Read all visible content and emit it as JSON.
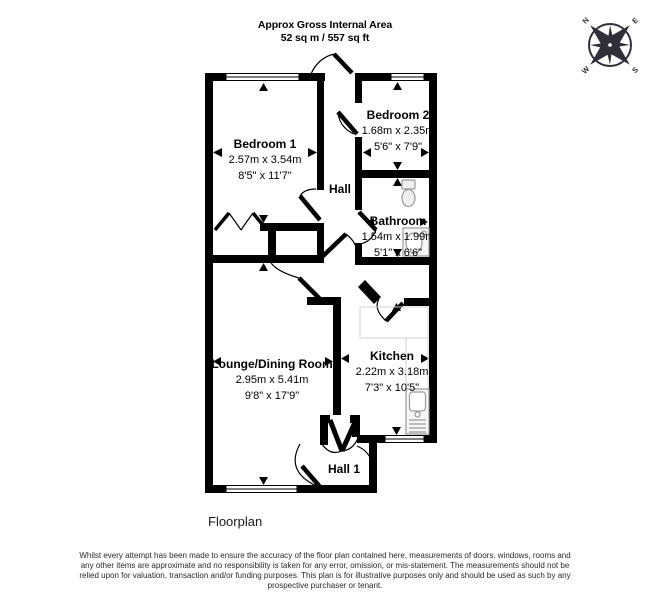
{
  "header": {
    "line1": "Approx Gross Internal Area",
    "line2": "52 sq m / 557 sq ft"
  },
  "compass": {
    "n": "N",
    "e": "E",
    "s": "S",
    "w": "W"
  },
  "rooms": [
    {
      "id": "bedroom1",
      "name": "Bedroom 1",
      "metric": "2.57m x 3.54m",
      "imperial": "8'5\" x 11'7\""
    },
    {
      "id": "bedroom2",
      "name": "Bedroom 2",
      "metric": "1.68m x 2.35m",
      "imperial": "5'6\" x 7'9\""
    },
    {
      "id": "bathroom",
      "name": "Bathroom",
      "metric": "1.54m x 1.99m",
      "imperial": "5'1\" x 6'6\""
    },
    {
      "id": "lounge",
      "name": "Lounge/Dining Room",
      "metric": "2.95m x 5.41m",
      "imperial": "9'8\" x 17'9\""
    },
    {
      "id": "kitchen",
      "name": "Kitchen",
      "metric": "2.22m x 3.18m",
      "imperial": "7'3\" x 10'5\""
    },
    {
      "id": "hall1",
      "name": "Hall 1"
    },
    {
      "id": "hall2",
      "name": "Hall 2"
    }
  ],
  "caption": "Floorplan",
  "disclaimer": {
    "lines": [
      "Whilst every attempt has been made to ensure the accuracy of the floor plan contained here, measurements of doors, windows, rooms and",
      "any other items are approximate and no responsibility is taken for any error, omission, or mis-statement. The measurements should not be",
      "relied upon for valuation, transaction and/or funding purposes. This plan is for illustrative purposes only and should be used as such by any",
      "prospective purchaser or tenant."
    ]
  },
  "colors": {
    "wall": "#000000",
    "background": "#ffffff",
    "fixture": "#9a9a9a",
    "counter": "#d0d0d0",
    "compass": "#2f2f3a"
  }
}
